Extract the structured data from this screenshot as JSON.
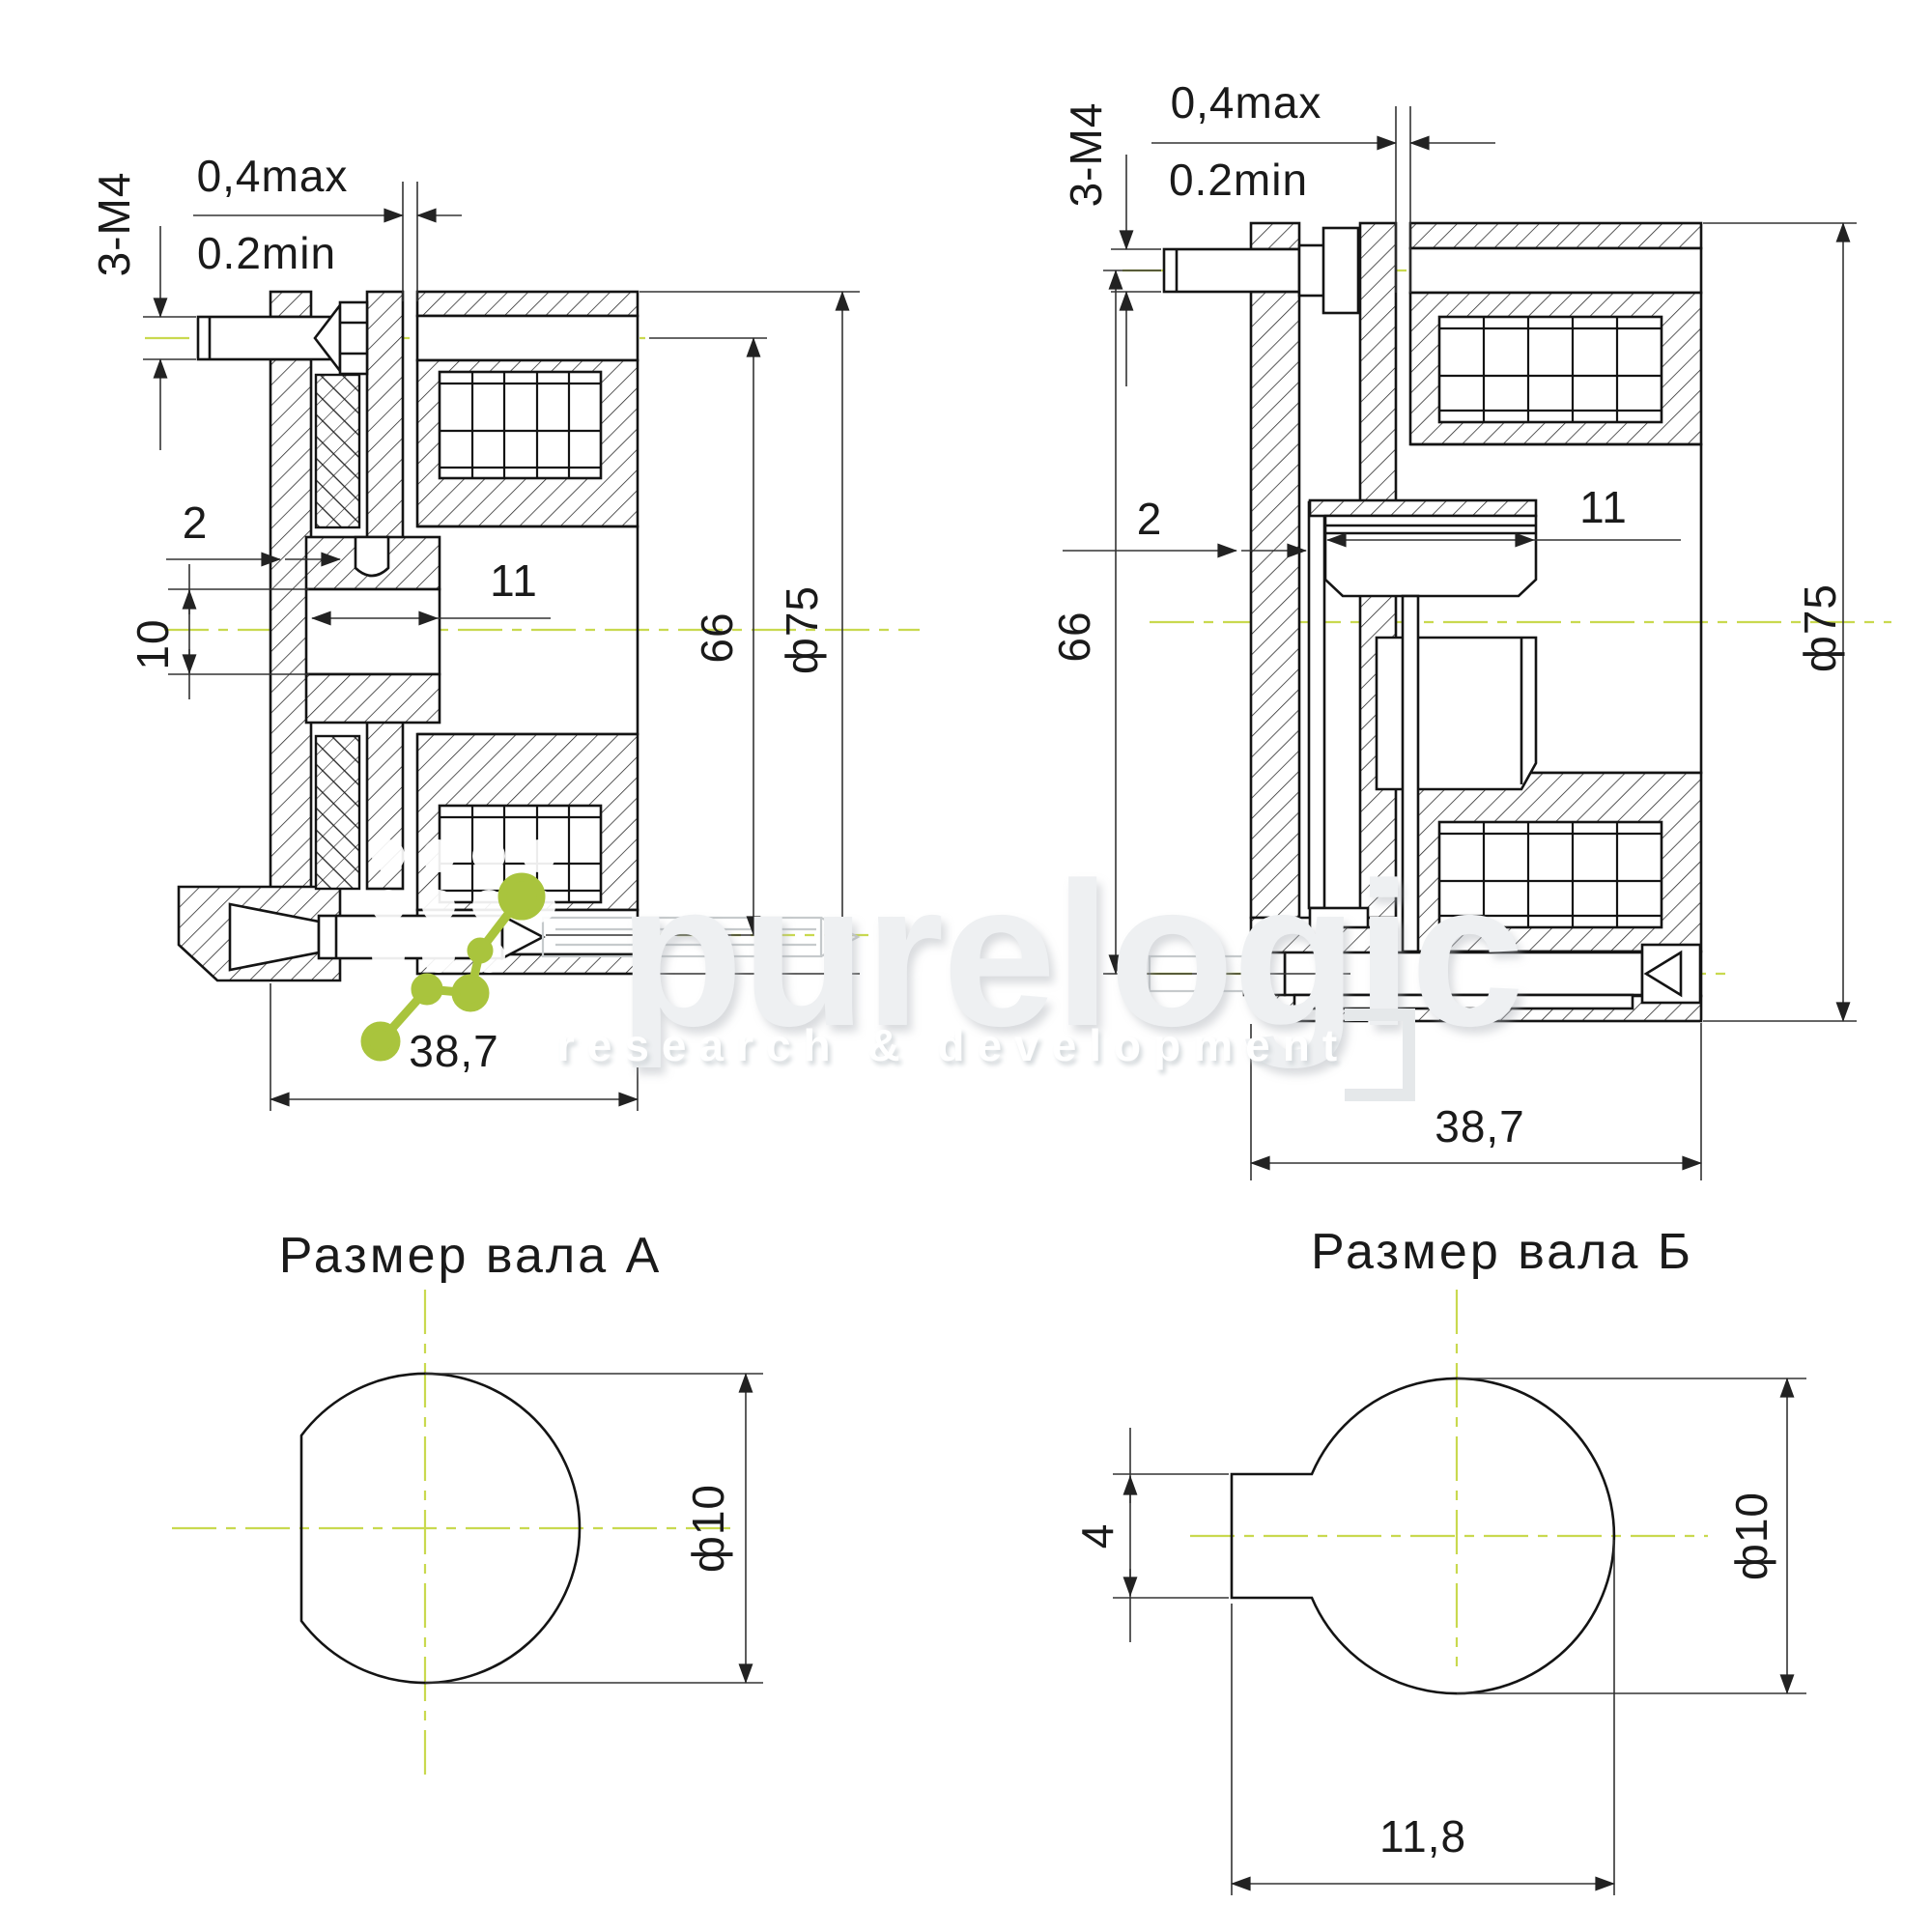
{
  "watermark": {
    "brand": "purelogic",
    "tagline": "research & development"
  },
  "section_view_a": {
    "air_gap_max": "0,4max",
    "air_gap_min": "0.2min",
    "mount_screws": "3-М4",
    "disc_thickness": "2",
    "bore_diameter": "10",
    "hub_length": "11",
    "bolt_circle_diameter": "66",
    "outer_diameter": "ф75",
    "axial_length": "38,7"
  },
  "section_view_b": {
    "air_gap_max": "0,4max",
    "air_gap_min": "0.2min",
    "mount_screws": "3-М4",
    "disc_thickness": "2",
    "hub_length": "11",
    "bolt_circle_diameter": "66",
    "outer_diameter": "ф75",
    "axial_length": "38,7"
  },
  "shaft_view_a": {
    "title": "Размер вала А",
    "shaft_diameter": "ф10"
  },
  "shaft_view_b": {
    "title": "Размер вала Б",
    "key_slot_width": "4",
    "shaft_diameter": "ф10",
    "flat_length": "11,8"
  },
  "colors": {
    "line": "#141414",
    "dimension_line": "#333333",
    "centerline": "#c9d94f",
    "logo_green": "#a9c43d",
    "watermark_gray": "#eef0f2"
  }
}
